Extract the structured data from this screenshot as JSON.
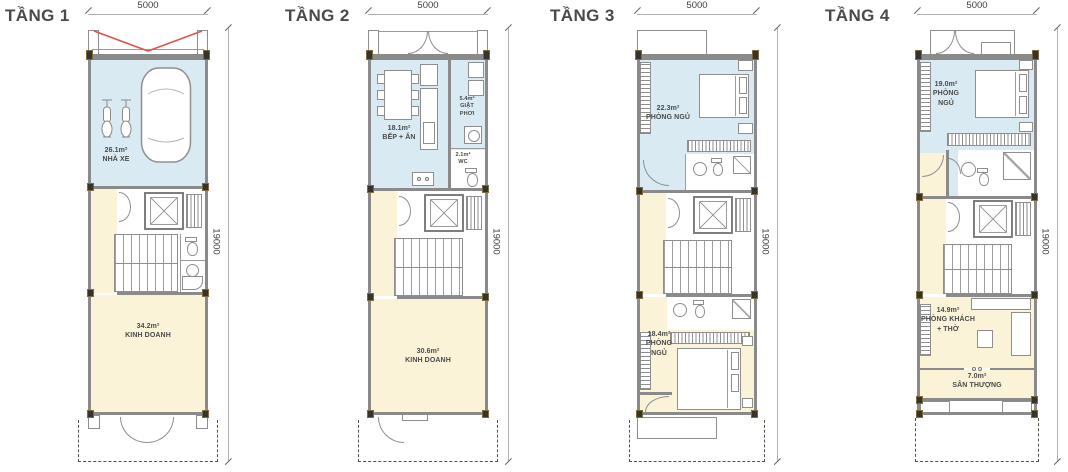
{
  "sheet_title": "Mặt bằng tầng",
  "colors": {
    "room_blue": "#d9eaf3",
    "room_cream": "#faf3d8",
    "wall_gray": "#8a8a8a",
    "gate_red": "#e0544a",
    "label_text": "#4a4a49"
  },
  "floors": [
    {
      "title": "TẦNG 1",
      "dim_width": "5000",
      "dim_height": "19000",
      "rooms": {
        "garage": {
          "area": "26.1m²",
          "name": "NHÀ XE"
        },
        "business": {
          "area": "34.2m²",
          "name": "KINH DOANH"
        }
      }
    },
    {
      "title": "TẦNG 2",
      "dim_width": "5000",
      "dim_height": "19000",
      "rooms": {
        "kitchen": {
          "area": "18.1m²",
          "name": "BẾP + ĂN"
        },
        "laundry": {
          "area": "5.4m²",
          "line1": "GIẶT",
          "line2": "PHƠI"
        },
        "wc": {
          "area": "2.1m²",
          "name": "WC"
        },
        "business": {
          "area": "30.6m²",
          "name": "KINH DOANH"
        }
      }
    },
    {
      "title": "TẦNG 3",
      "dim_width": "5000",
      "dim_height": "19000",
      "rooms": {
        "bedroom1": {
          "area": "22.3m²",
          "name": "PHÒNG NGỦ"
        },
        "bedroom2": {
          "area": "18.4m²",
          "line1": "PHÒNG",
          "line2": "NGỦ"
        }
      }
    },
    {
      "title": "TẦNG 4",
      "dim_width": "5000",
      "dim_height": "19000",
      "rooms": {
        "bedroom": {
          "area": "19.0m²",
          "line1": "PHÒNG",
          "line2": "NGỦ"
        },
        "living": {
          "area": "14.9m²",
          "line1": "PHÒNG KHÁCH",
          "line2": "+ THỜ"
        },
        "terrace": {
          "area": "7.0m²",
          "name": "SÂN THƯỢNG"
        }
      }
    }
  ]
}
